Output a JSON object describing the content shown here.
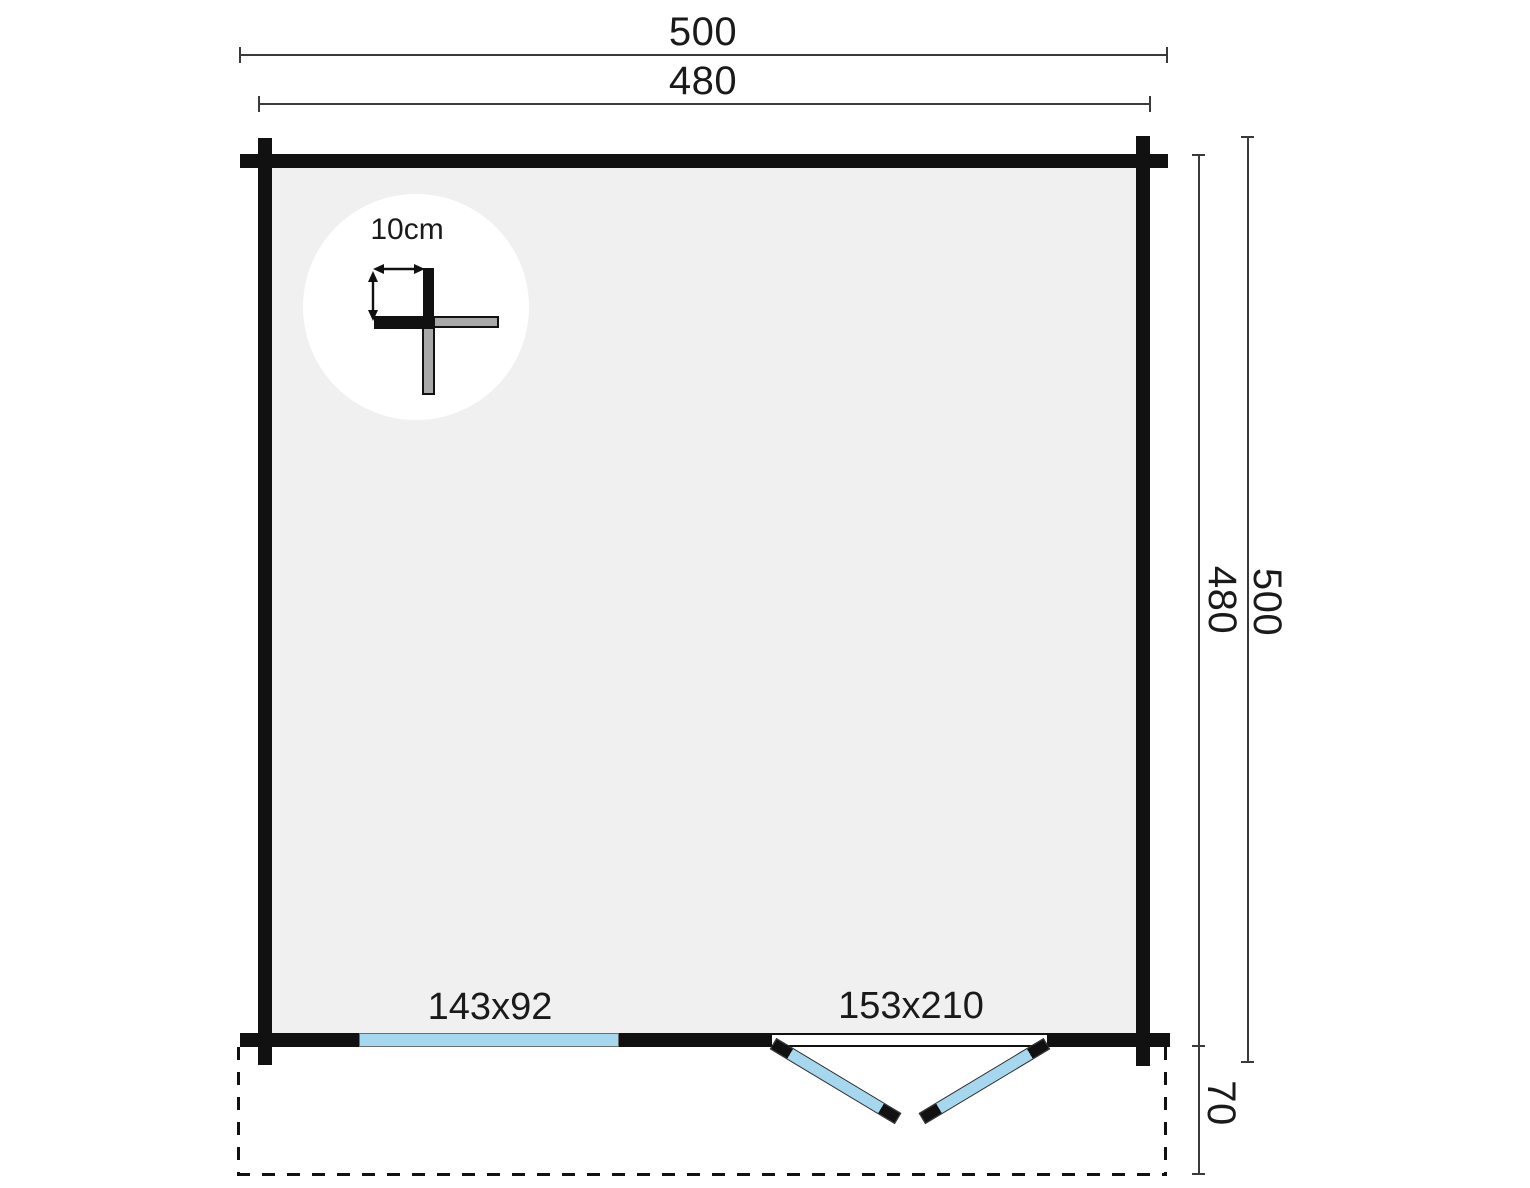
{
  "plan": {
    "dimensions": {
      "overall_width": "500",
      "wall_width": "480",
      "wall_height": "480",
      "overall_height": "500",
      "terrace_depth": "70"
    },
    "detail": {
      "log_thickness": "10cm"
    },
    "openings": {
      "window_size": "143x92",
      "door_size": "153x210"
    },
    "colors": {
      "wall": "#111111",
      "interior": "#f0f0f0",
      "glazing": "#a5d7ef",
      "log_gray": "#a8a8a8",
      "dim": "#3a3a3a",
      "text": "#1a1a1a"
    }
  }
}
